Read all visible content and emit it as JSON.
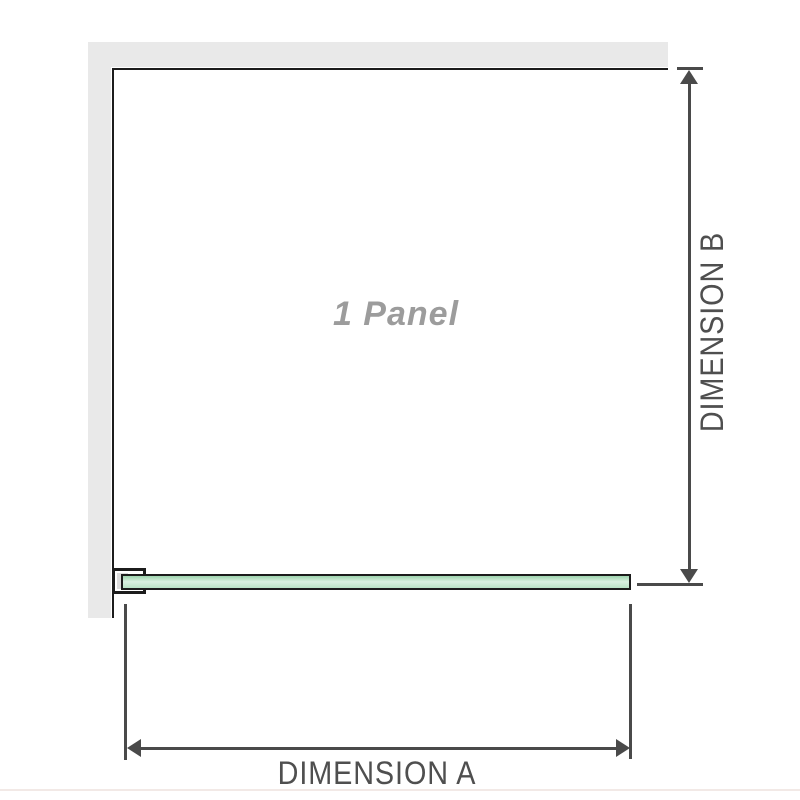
{
  "diagram": {
    "panel_label": "1 Panel",
    "dimension_a_label": "DIMENSION A",
    "dimension_b_label": "DIMENSION B"
  },
  "colors": {
    "background": "#ffffff",
    "wall": "#e9e9e9",
    "outline": "#1c1c1c",
    "dimension": "#4a4a4a",
    "label": "#9c9c9c",
    "dim_label": "#4f4f4f",
    "glass_fill": "#b9e3c6",
    "glass_highlight": "#d9f0e0",
    "glass_edge": "#9ed4ae",
    "bracket_fill": "#dcdcdc",
    "footer_divider": "#f2e9e6"
  }
}
